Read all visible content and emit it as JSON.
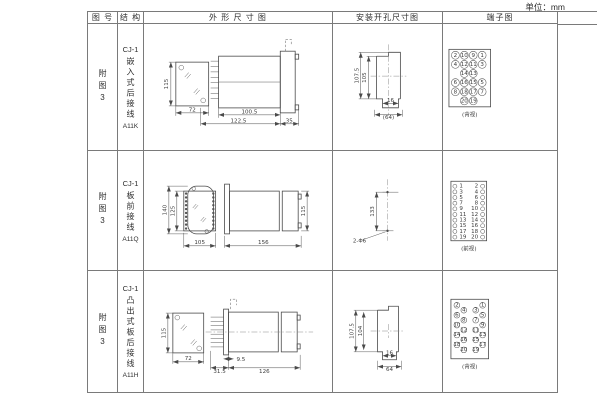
{
  "page": {
    "unit": "单位：mm"
  },
  "header": {
    "fig": "图 号",
    "structure": "结 构",
    "outline": "外 形 尺 寸 图",
    "install": "安装开孔尺寸图",
    "terminal": "端子图"
  },
  "rows": [
    {
      "fig": "附图3",
      "structure": {
        "model": "CJ-1",
        "name": "嵌入式后接线",
        "code": "A11K"
      },
      "outline": {
        "h": "115",
        "w": "72",
        "body": "100.5",
        "total": "122.5",
        "flange": "35"
      },
      "install": {
        "h1": "107.5",
        "h2": "105",
        "w1": "16",
        "w2": "(64)"
      },
      "terminal": {
        "caption": "(背视)",
        "grid": [
          [
            "2",
            "10",
            "9",
            "1"
          ],
          [
            "4",
            "12",
            "11",
            "3"
          ],
          [
            null,
            "14",
            "13",
            null
          ],
          [
            "6",
            "16",
            "15",
            "5"
          ],
          [
            "8",
            "18",
            "17",
            "7"
          ],
          [
            null,
            "20",
            "19",
            null
          ]
        ]
      }
    },
    {
      "fig": "附图3",
      "structure": {
        "model": "CJ-1",
        "name": "板前接线",
        "code": "A11Q"
      },
      "outline": {
        "h": "140",
        "h2": "125",
        "w": "105",
        "len": "156",
        "side_h": "115"
      },
      "install": {
        "h1": "133",
        "hole": "2-Φ6"
      },
      "terminal": {
        "caption": "(前视)",
        "grid": [
          [
            "1",
            "2"
          ],
          [
            "3",
            "4"
          ],
          [
            "5",
            "6"
          ],
          [
            "7",
            "8"
          ],
          [
            "9",
            "10"
          ],
          [
            "11",
            "12"
          ],
          [
            "13",
            "14"
          ],
          [
            "15",
            "16"
          ],
          [
            "17",
            "18"
          ],
          [
            "19",
            "20"
          ]
        ]
      }
    },
    {
      "fig": "附图3",
      "structure": {
        "model": "CJ-1",
        "name": "凸出式板后接线",
        "code": "A11H"
      },
      "outline": {
        "h": "115",
        "w": "72",
        "d1": "9.5",
        "d2": "31.5",
        "d3": "126"
      },
      "install": {
        "h1": "107.5",
        "h2": "104",
        "w1": "16",
        "w2": "64"
      },
      "terminal": {
        "caption": "(背视)",
        "grid": [
          [
            "2",
            "4",
            "3",
            "1"
          ],
          [
            "6",
            "8",
            "7",
            "5"
          ],
          [
            "10",
            "12",
            "11",
            "9"
          ],
          [
            "14",
            "16",
            "15",
            "13"
          ],
          [
            "18",
            "20",
            "19",
            "17"
          ]
        ]
      }
    }
  ]
}
